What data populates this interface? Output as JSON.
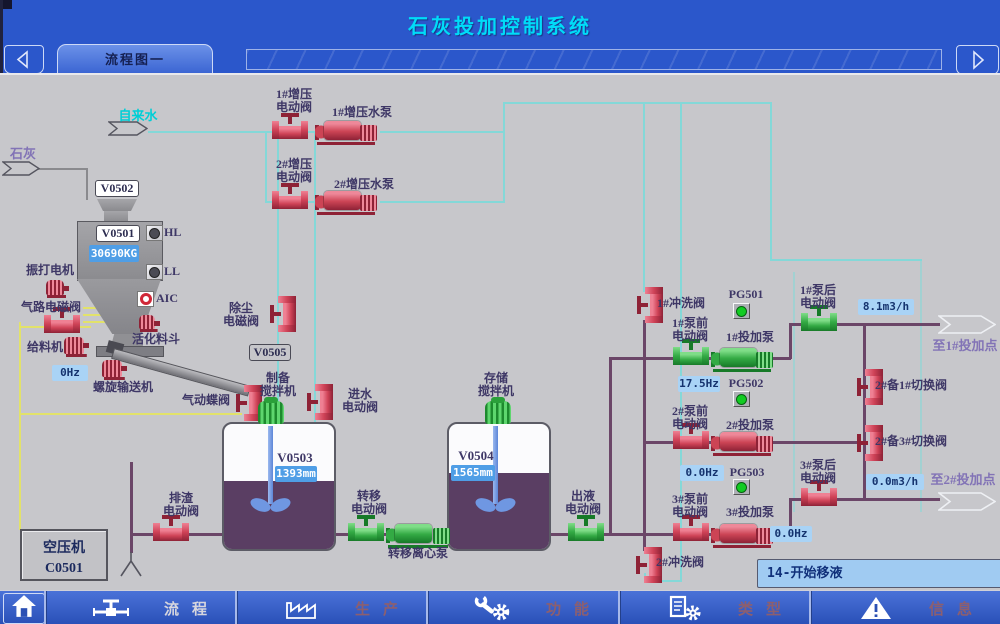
{
  "header": {
    "title": "石灰投加控制系统",
    "tab": "流程图一"
  },
  "nav": {
    "items": [
      {
        "id": "flow",
        "label": "流程",
        "active": true
      },
      {
        "id": "production",
        "label": "生产",
        "active": false
      },
      {
        "id": "function",
        "label": "功能",
        "active": false
      },
      {
        "id": "type",
        "label": "类型",
        "active": false
      },
      {
        "id": "info",
        "label": "信息",
        "active": false
      }
    ]
  },
  "labels": {
    "tap_water": "自来水",
    "lime": "石灰",
    "v0502": "V0502",
    "v0501": "V0501",
    "v0505": "V0505",
    "v0503": "V0503",
    "v0504": "V0504",
    "vibrator": "振打电机",
    "air_valve": "气路电磁阀",
    "feeder": "给料机",
    "screw_conveyor": "螺旋输送机",
    "activation_hopper": "活化料斗",
    "dust_valve": "除尘\n电磁阀",
    "booster1_valve": "1#增压\n电动阀",
    "booster1_pump": "1#增压水泵",
    "booster2_valve": "2#增压\n电动阀",
    "booster2_pump": "2#增压水泵",
    "prep_mixer": "制备\n搅拌机",
    "inlet_valve": "进水\n电动阀",
    "butterfly_valve": "气动蝶阀",
    "storage_mixer": "存储\n搅拌机",
    "drain_valve": "排渣\n电动阀",
    "transfer_valve": "转移\n电动阀",
    "transfer_pump": "转移离心泵",
    "outlet_valve": "出液\n电动阀",
    "compressor": "空压机\nC0501",
    "flush1": "1#冲洗阀",
    "flush2": "2#冲洗阀",
    "pre1": "1#泵前\n电动阀",
    "pre2": "2#泵前\n电动阀",
    "pre3": "3#泵前\n电动阀",
    "post1": "1#泵后\n电动阀",
    "post3": "3#泵后\n电动阀",
    "dosing1": "1#投加泵",
    "dosing2": "2#投加泵",
    "dosing3": "3#投加泵",
    "switch21": "2#备1#切换阀",
    "switch23": "2#备3#切换阀",
    "to_point1": "至1#投加点",
    "to_point2": "至2#投加点"
  },
  "indicators": {
    "hl": "HL",
    "ll": "LL",
    "aic": "AIC",
    "pg501": "PG501",
    "pg502": "PG502",
    "pg503": "PG503"
  },
  "values": {
    "silo_weight": "30690KG",
    "feeder_hz": "0Hz",
    "tank1_level": "1393mm",
    "tank2_level": "1565mm",
    "pump1_hz": "17.5Hz",
    "pump2_hz": "0.0Hz",
    "pump3_hz": "0.0Hz",
    "flow1": "8.1m3/h",
    "flow2": "0.0m3/h",
    "status": "14-开始移液"
  },
  "colors": {
    "header_blue": "#2b57cb",
    "title_cyan": "#00dcf8",
    "canvas_gray": "#c7c7cb",
    "pipe_water": "#84d8d8",
    "pipe_air": "#e2e26a",
    "pipe_slurry": "#6b4668",
    "device_red": "#cc4455",
    "device_green": "#33aa44",
    "value_blue": "#a9d3f6",
    "liquid_purple": "#5a3e63"
  }
}
